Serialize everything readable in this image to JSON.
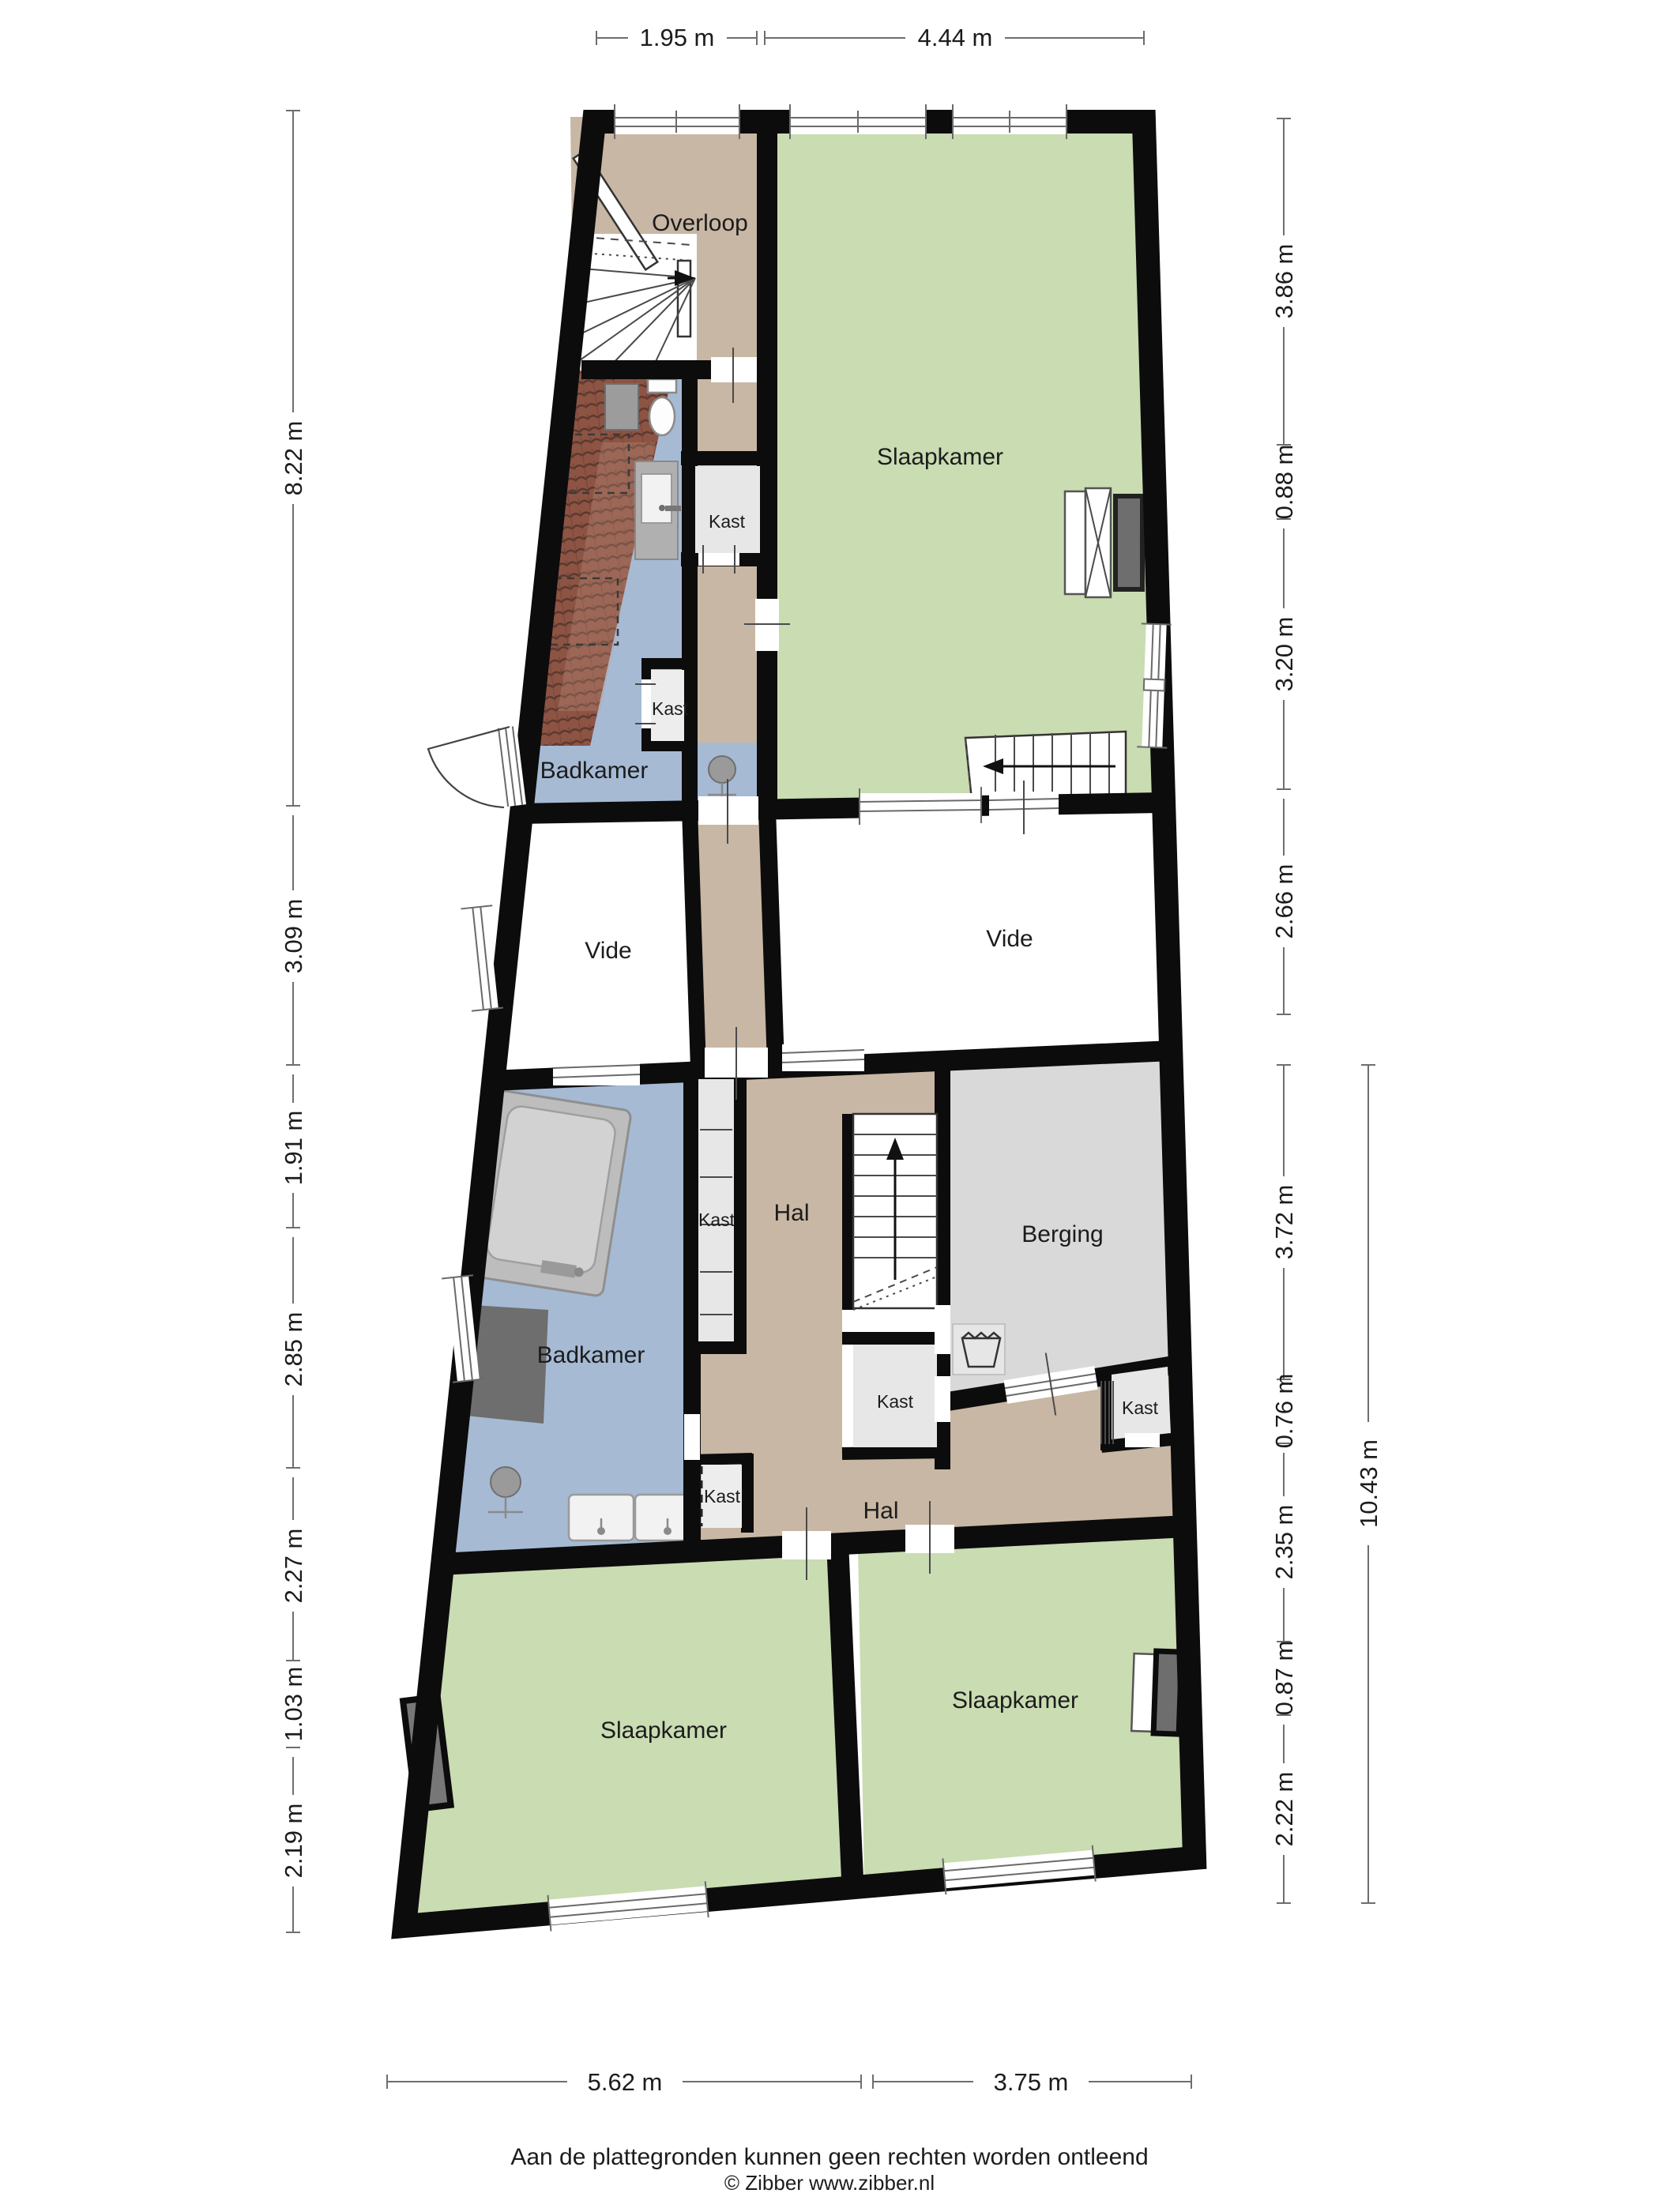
{
  "plan": {
    "title": "floor-plan",
    "footer": {
      "disclaimer": "Aan de plattegronden kunnen geen rechten worden ontleend",
      "copyright": "© Zibber www.zibber.nl"
    },
    "rooms": {
      "overloop": "Overloop",
      "slaapkamer_top": "Slaapkamer",
      "badkamer_top": "Badkamer",
      "kast_top1": "Kast",
      "kast_top2": "Kast",
      "vide_left": "Vide",
      "vide_right": "Vide",
      "kast_mid_tall": "Kast",
      "hal_boven": "Hal",
      "berging": "Berging",
      "kast_onder_trap": "Kast",
      "badkamer_mid": "Badkamer",
      "kast_rechts": "Kast",
      "kast_bij_wastafels": "Kast",
      "hal_onder": "Hal",
      "slaapkamer_links": "Slaapkamer",
      "slaapkamer_rechts": "Slaapkamer"
    },
    "dimensions": {
      "top": [
        "1.95 m",
        "4.44 m"
      ],
      "left": [
        "8.22 m",
        "3.09 m",
        "1.91 m",
        "2.85 m",
        "2.27 m",
        "1.03 m",
        "2.19 m"
      ],
      "right": [
        "3.86 m",
        "0.88 m",
        "3.20 m",
        "2.66 m",
        "3.72 m",
        "0.76 m",
        "2.35 m",
        "0.87 m",
        "2.22 m"
      ],
      "right_total": "10.43 m",
      "bottom": [
        "5.62 m",
        "3.75 m"
      ]
    },
    "icons": [
      "stairs-icon",
      "bathtub-icon",
      "shower-icon",
      "double-sink-icon",
      "sink-icon",
      "toilet-icon",
      "washing-machine-icon",
      "wardrobe-icon",
      "radiator-icon",
      "door-swing-icon",
      "roof-tiles",
      "roof-window-icon"
    ],
    "colors": {
      "bedroom_green": "#c9dcb2",
      "bath_blue": "#a6bad4",
      "hall_tan": "#c8b7a4",
      "storage_grey": "#d9d9d9",
      "closet_grey": "#e7e7e7",
      "wall_black": "#0c0c0c",
      "roof_tile": "#8d5444",
      "vide_white": "#ffffff"
    }
  }
}
